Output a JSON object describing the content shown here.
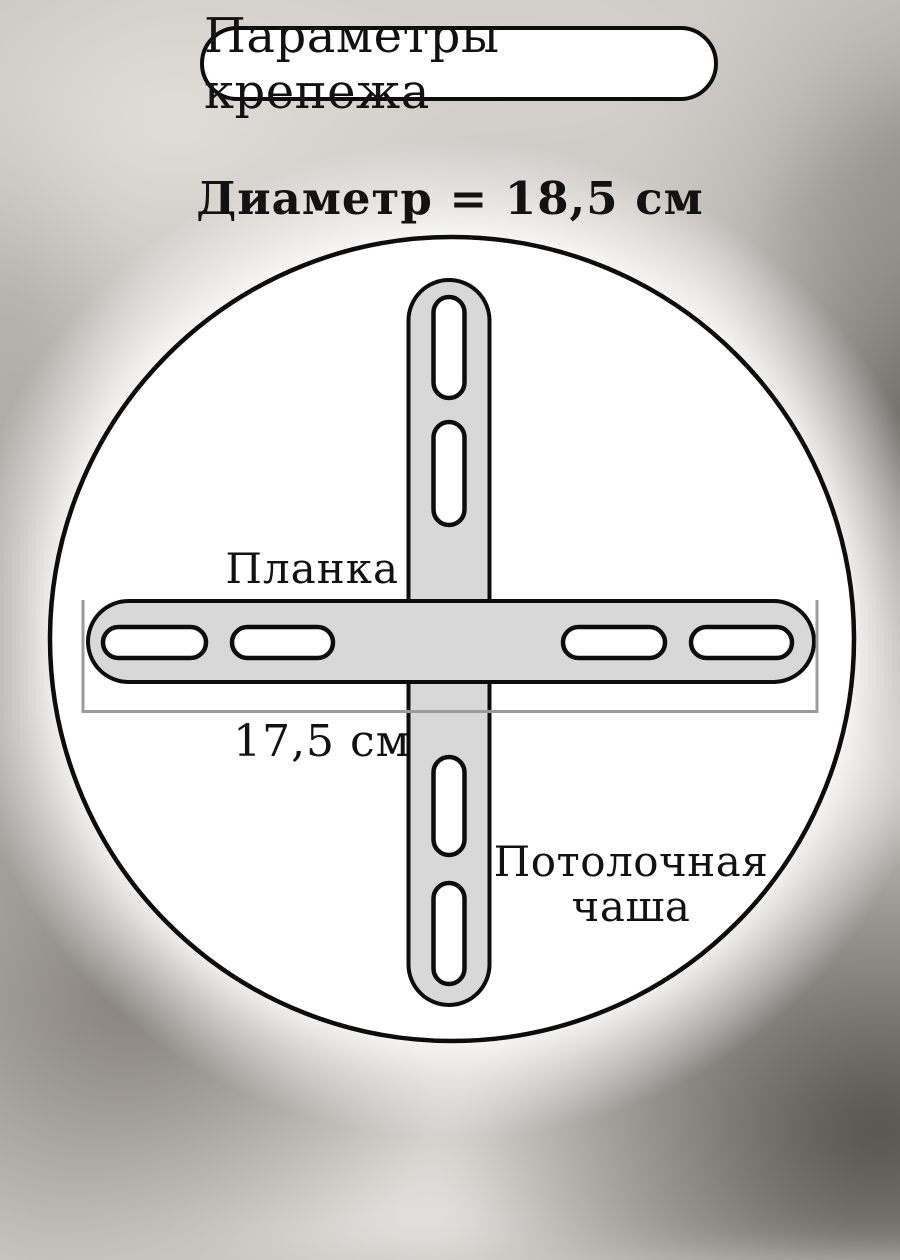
{
  "title_badge": {
    "label": "Параметры крепежа"
  },
  "annotations": {
    "diameter": "Диаметр = 18,5 см",
    "plank": "Планка",
    "plank_length": "17,5 см",
    "ceiling_cup": "Потолочная чаша"
  },
  "colors": {
    "circle_fill": "#ffffff",
    "plank_fill": "#d8d8d8",
    "outline": "#0d0d0d",
    "measure_line": "#9b9b9b",
    "text": "#121212",
    "background_base": "#c9c5c1"
  }
}
